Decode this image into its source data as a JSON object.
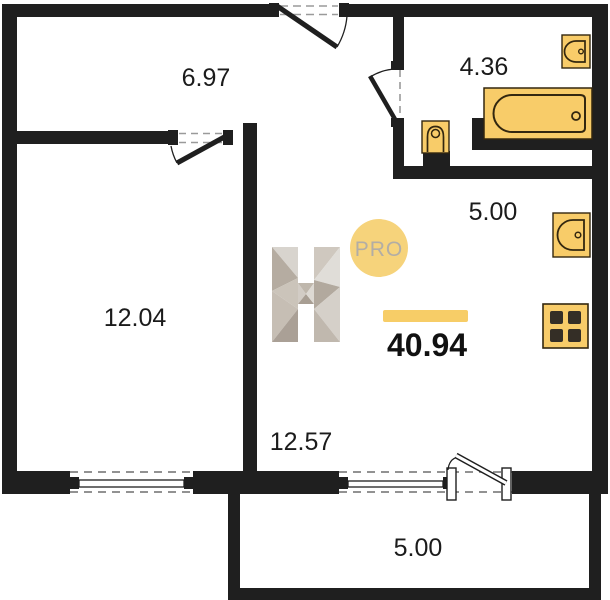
{
  "plan": {
    "title": "apartment floor plan",
    "total_area": "40.94",
    "rooms": {
      "hallway": "6.97",
      "bathroom": "4.36",
      "bedroom": "12.04",
      "kitchen": "5.00",
      "living_room": "12.57",
      "balcony": "5.00"
    },
    "logo": {
      "letter": "H",
      "badge_label": "PRO"
    },
    "colors": {
      "wall": "#1f1f1f",
      "fixture_fill": "#f8cc69",
      "fixture_stroke": "#33270f",
      "accent_bar": "#f7cd67",
      "badge_fill": "#f6d37b",
      "badge_text": "#b2ada5",
      "label_text": "#1b1b1b"
    }
  }
}
